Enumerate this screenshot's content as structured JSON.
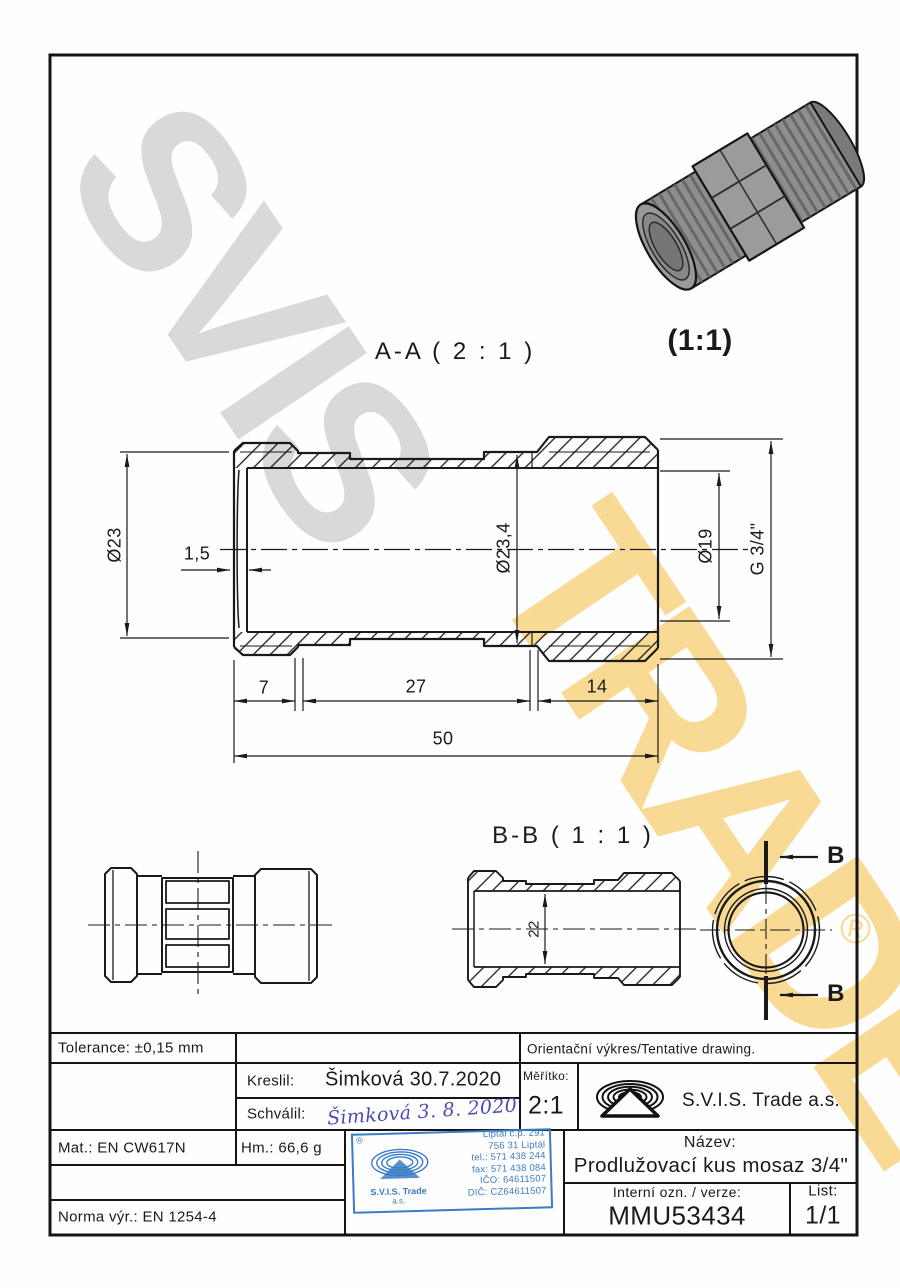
{
  "watermark": {
    "gray": "SVIS",
    "yellow": "TRADE",
    "reg": "®"
  },
  "views": {
    "aa": "A-A ( 2 : 1 )",
    "iso": "(1:1)",
    "bb": "B-B ( 1 : 1 )",
    "cut_marker_top": "B",
    "cut_marker_bottom": "B"
  },
  "dims": {
    "dia23": "Ø23",
    "wall": "1,5",
    "dia234": "Ø23,4",
    "dia19": "Ø19",
    "g34": "G 3/4\"",
    "l7": "7",
    "l27": "27",
    "l14": "14",
    "l50": "50",
    "d22": "22"
  },
  "titleblock": {
    "tolerance": "Tolerance: ±0,15 mm",
    "orientacni": "Orientační výkres/Tentative drawing.",
    "kreslil_label": "Kreslil:",
    "kreslil_value": "Šimková 30.7.2020",
    "schvalil_label": "Schválil:",
    "schvalil_value": "Šimková 3. 8. 2020",
    "meritko_label": "Měřítko:",
    "meritko_value": "2:1",
    "company": "S.V.I.S. Trade a.s.",
    "mat": "Mat.: EN CW617N",
    "hm": "Hm.: 66,6 g",
    "norma": "Norma výr.: EN 1254-4",
    "nazev_label": "Název:",
    "nazev_value": "Prodlužovací kus mosaz 3/4\"",
    "interni_label": "Interní ozn. / verze:",
    "interni_value": "MMU53434",
    "list_label": "List:",
    "list_value": "1/1"
  },
  "stamp": {
    "reg": "®",
    "lines": [
      "Liptál č.p. 291",
      "756 31 Liptál",
      "tel.: 571 438 244",
      "fax: 571 438 084",
      "IČO: 64611507",
      "DIČ: CZ64611507"
    ],
    "company": "S.V.I.S. Trade",
    "company_suffix": "a.s."
  }
}
